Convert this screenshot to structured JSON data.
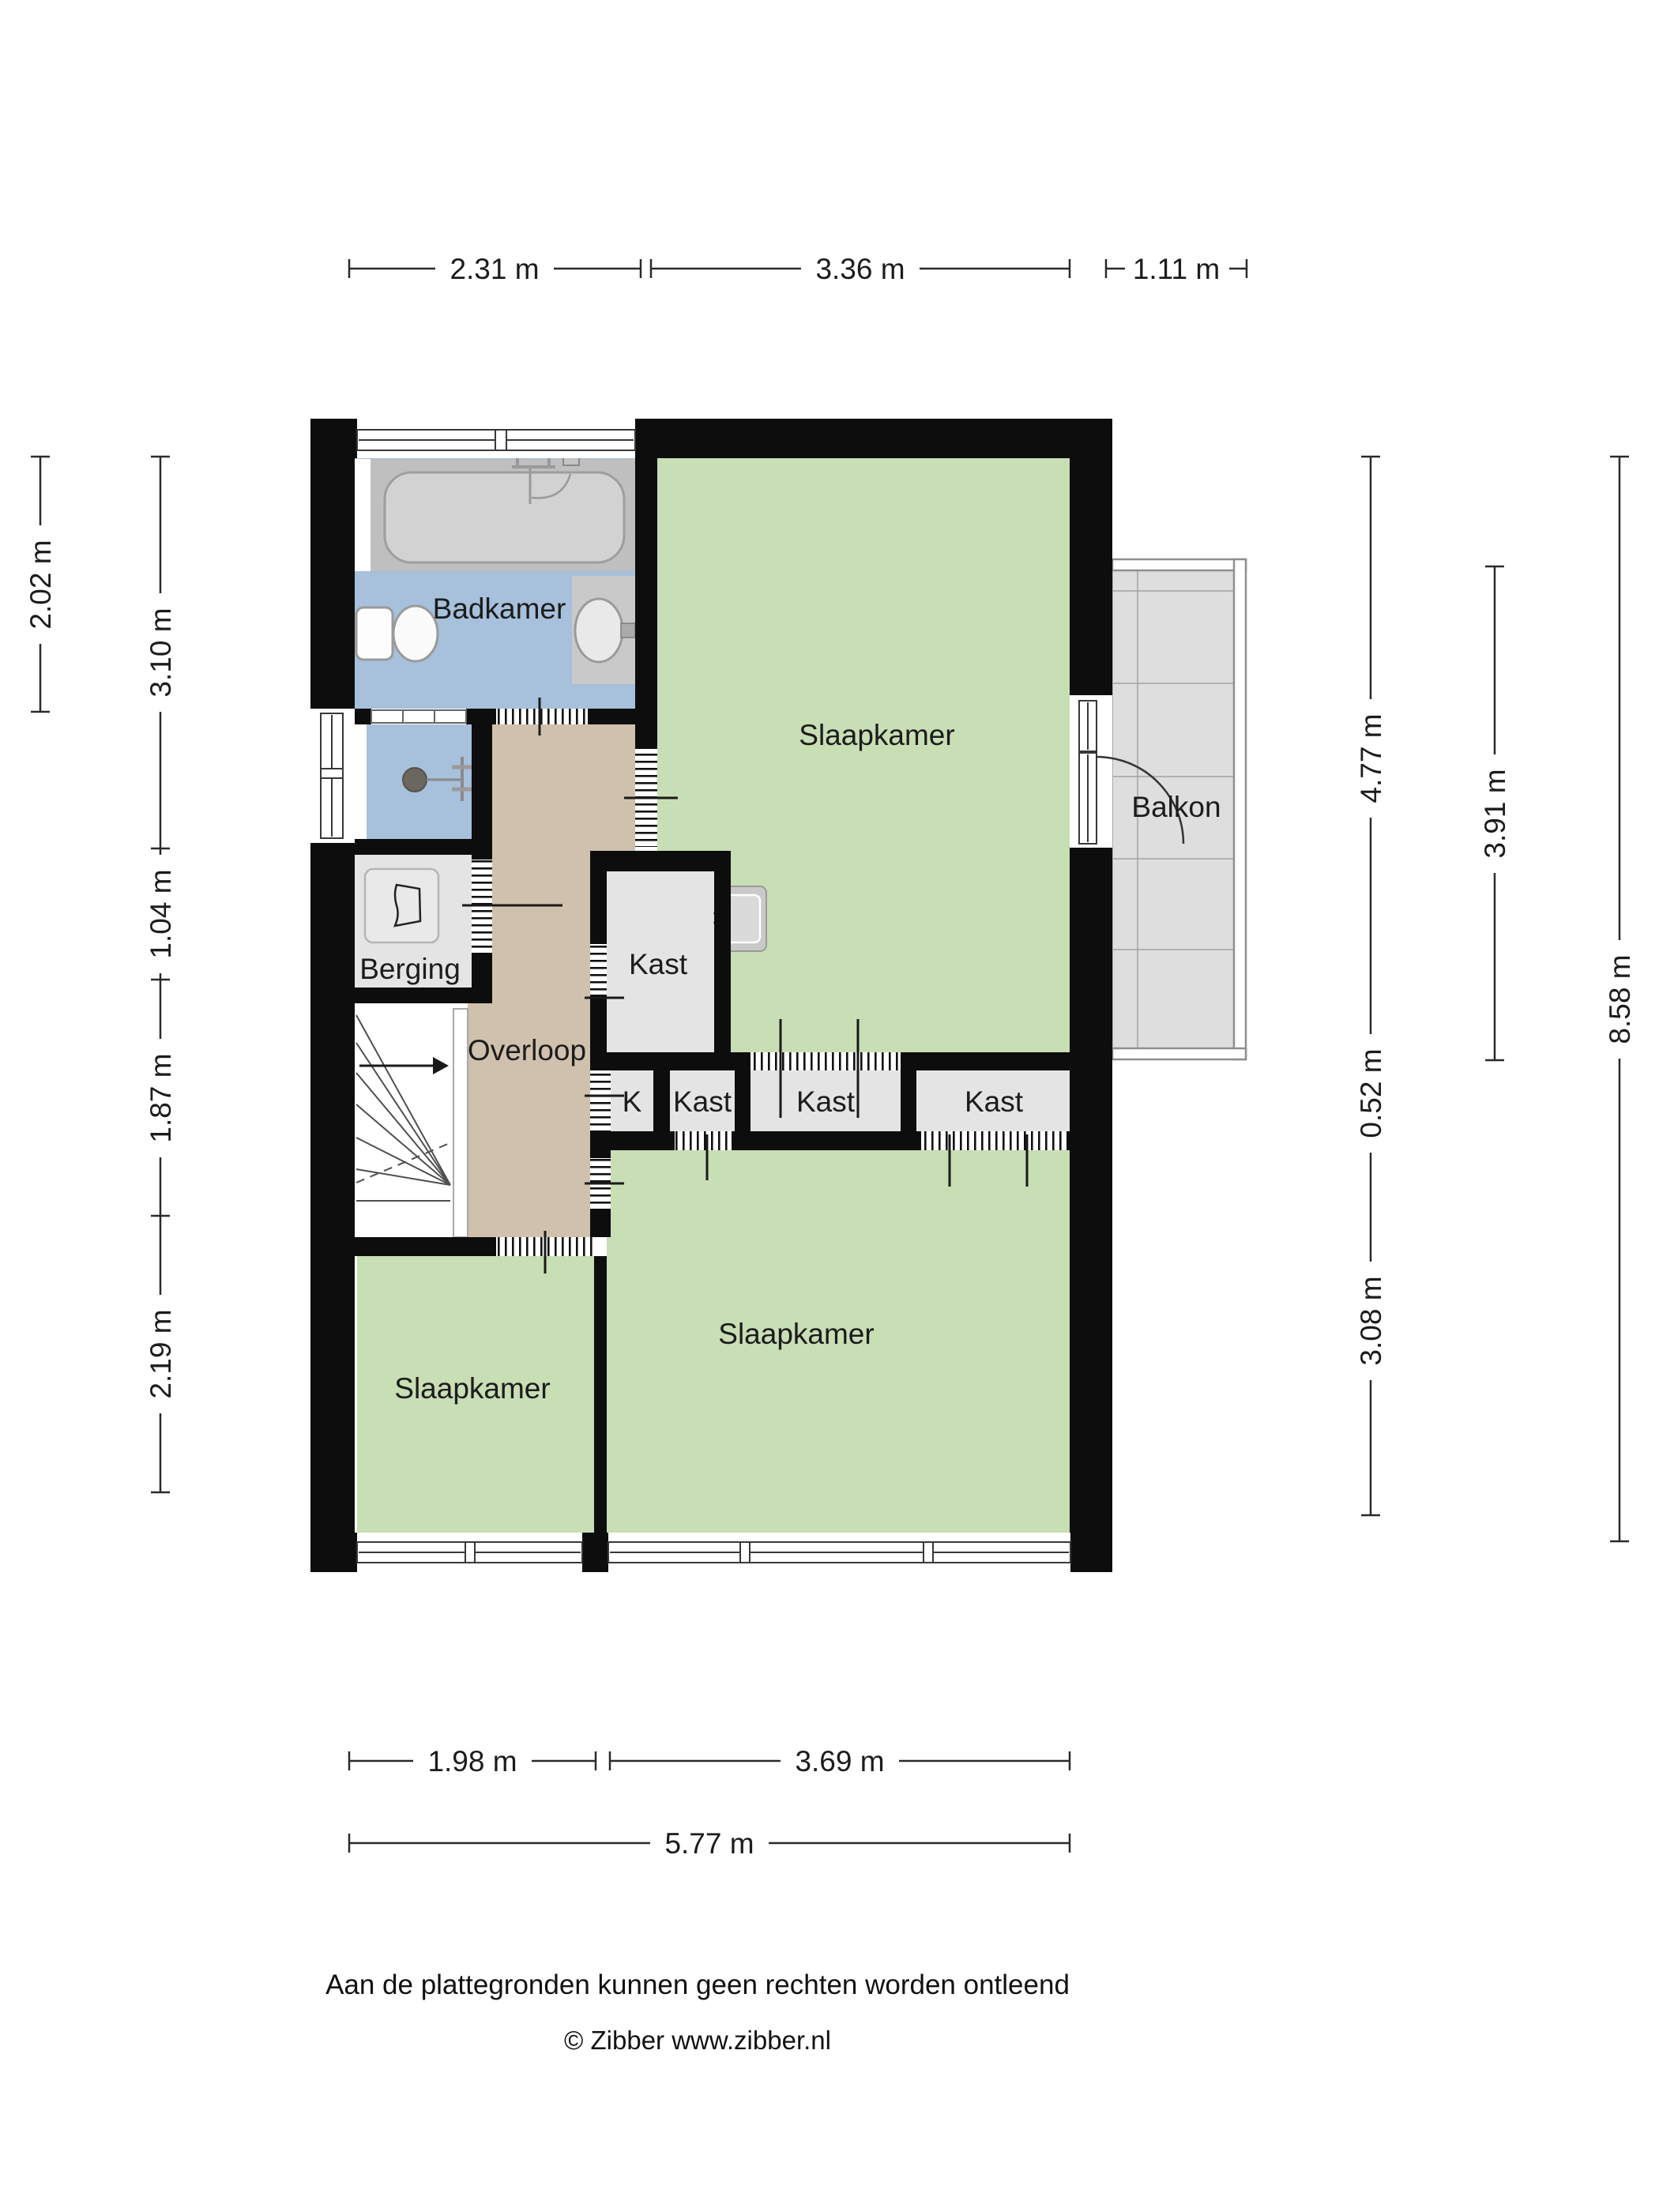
{
  "plan": {
    "rooms": {
      "badkamer": "Badkamer",
      "slaapkamer_top": "Slaapkamer",
      "balkon": "Balkon",
      "berging": "Berging",
      "overloop": "Overloop",
      "kast_large": "Kast",
      "kast_k": "K",
      "kast_small": "Kast",
      "kast_middle": "Kast",
      "kast_right": "Kast",
      "slaapkamer_left": "Slaapkamer",
      "slaapkamer_bottom": "Slaapkamer"
    },
    "dimensions_m": {
      "top": [
        "2.31 m",
        "3.36 m",
        "1.11 m"
      ],
      "left_outer": "2.02 m",
      "left": [
        "3.10 m",
        "1.04 m",
        "1.87 m",
        "2.19 m"
      ],
      "right_inner": [
        "4.77 m",
        "0.52 m",
        "3.08 m"
      ],
      "right_balcony": "3.91 m",
      "right_total": "8.58 m",
      "bottom": [
        "1.98 m",
        "3.69 m"
      ],
      "bottom_total": "5.77 m"
    },
    "footer": {
      "disclaimer": "Aan de plattegronden kunnen geen rechten worden ontleend",
      "copyright": "© Zibber www.zibber.nl"
    },
    "colors": {
      "wall": "#0d0d0d",
      "room_green": "#c8deb4",
      "room_blue": "#a7c0db",
      "room_tan": "#cfc1ad",
      "closet_gray": "#e4e4e4",
      "balcony_gray": "#dedede",
      "tub_gray": "#bfbfbf"
    }
  }
}
